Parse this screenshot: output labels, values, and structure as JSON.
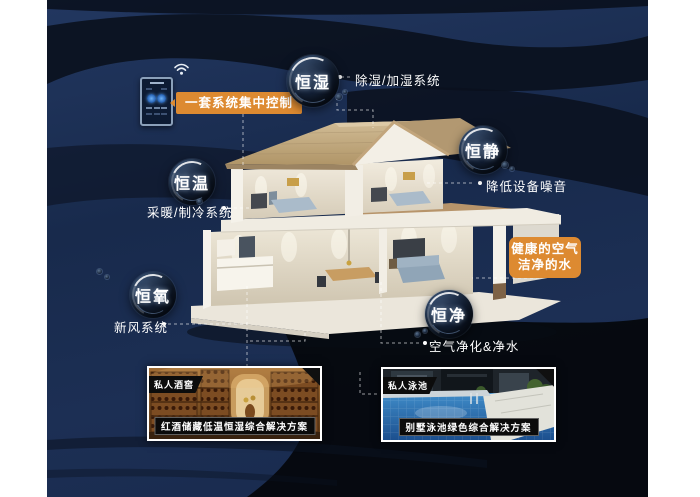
{
  "colors": {
    "accent_orange": "#dd8a31",
    "navy_base": "#1a2b4c",
    "dark_band": "#0a111d",
    "text": "#ffffff"
  },
  "control": {
    "callout": "一套系统集中控制",
    "wifi_icon": "wifi-signal",
    "panel_icon": "smart-thermostat-panel"
  },
  "health_callout": {
    "line1": "健康的空气",
    "line2": "洁净的水"
  },
  "bubbles": [
    {
      "id": "humidity",
      "label": "恒湿",
      "note": "除湿/加湿系统"
    },
    {
      "id": "quiet",
      "label": "恒静",
      "note": "降低设备噪音"
    },
    {
      "id": "temperature",
      "label": "恒温",
      "note": "采暖/制冷系统"
    },
    {
      "id": "oxygen",
      "label": "恒氧",
      "note": "新风系统"
    },
    {
      "id": "purity",
      "label": "恒净",
      "note": "空气净化&净水"
    }
  ],
  "cards": [
    {
      "tag": "私人酒窖",
      "caption": "红酒储藏低温恒湿综合解决方案"
    },
    {
      "tag": "私人泳池",
      "caption": "别墅泳池绿色综合解决方案"
    }
  ]
}
